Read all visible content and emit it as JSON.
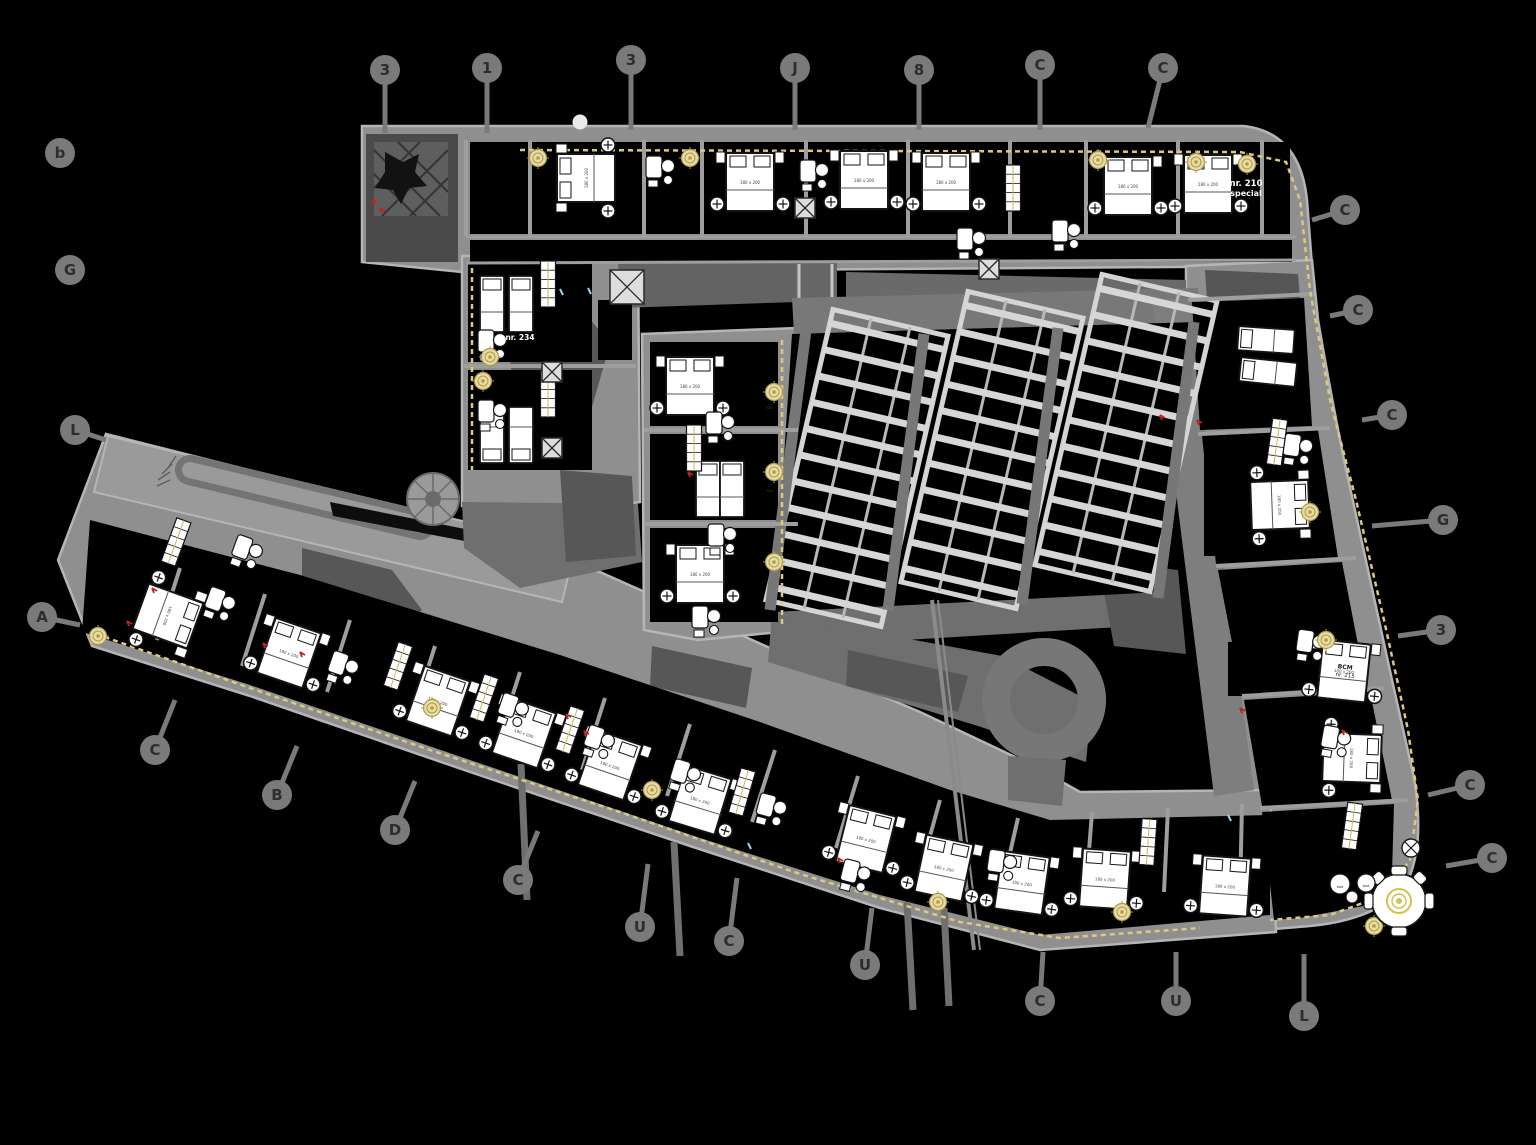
{
  "meta": {
    "title": "CAD hotel floor plan drawing"
  },
  "colors": {
    "bg": "#000000",
    "slab": "#8f8f8f",
    "slab_edge": "#b5b5b5",
    "corridor": "#6f6f6f",
    "clutter": "#575757",
    "partition": "#9e9e9e",
    "white": "#ffffff",
    "ink": "#141414",
    "beige": "#e7dca6",
    "beige_ring": "#b09a4a",
    "dash": "#d9ca7c",
    "red": "#c0221c",
    "cyan": "#93d7e6",
    "bubble": "#7a7a7a",
    "glyph": "#2d2d2d",
    "mullion": "#d4d4d4",
    "rail": "#b8b8b8",
    "walkway": "#787878"
  },
  "plan": {
    "bed_label": "180 x 200",
    "grid_bubbles": [
      {
        "x": 385,
        "y": 70,
        "g": "3",
        "ex": 385,
        "ey": 133
      },
      {
        "x": 487,
        "y": 68,
        "g": "1",
        "ex": 487,
        "ey": 133
      },
      {
        "x": 631,
        "y": 60,
        "g": "3",
        "ex": 631,
        "ey": 130
      },
      {
        "x": 795,
        "y": 68,
        "g": "J",
        "ex": 795,
        "ey": 130
      },
      {
        "x": 919,
        "y": 70,
        "g": "8",
        "ex": 919,
        "ey": 130
      },
      {
        "x": 1040,
        "y": 65,
        "g": "C",
        "ex": 1040,
        "ey": 130
      },
      {
        "x": 1163,
        "y": 68,
        "g": "C",
        "ex": 1148,
        "ey": 128
      },
      {
        "x": 60,
        "y": 153,
        "g": "b"
      },
      {
        "x": 70,
        "y": 270,
        "g": "G"
      },
      {
        "x": 75,
        "y": 430,
        "g": "L",
        "ex": 106,
        "ey": 440
      },
      {
        "x": 42,
        "y": 617,
        "g": "A",
        "ex": 80,
        "ey": 625
      },
      {
        "x": 155,
        "y": 750,
        "g": "C",
        "ex": 175,
        "ey": 700
      },
      {
        "x": 277,
        "y": 795,
        "g": "B",
        "ex": 297,
        "ey": 746
      },
      {
        "x": 395,
        "y": 830,
        "g": "D",
        "ex": 415,
        "ey": 781
      },
      {
        "x": 518,
        "y": 880,
        "g": "C",
        "ex": 538,
        "ey": 831
      },
      {
        "x": 640,
        "y": 927,
        "g": "U",
        "ex": 648,
        "ey": 864
      },
      {
        "x": 729,
        "y": 941,
        "g": "C",
        "ex": 737,
        "ey": 878
      },
      {
        "x": 865,
        "y": 965,
        "g": "U",
        "ex": 872,
        "ey": 908
      },
      {
        "x": 1040,
        "y": 1001,
        "g": "C",
        "ex": 1043,
        "ey": 952
      },
      {
        "x": 1176,
        "y": 1001,
        "g": "U",
        "ex": 1176,
        "ey": 952
      },
      {
        "x": 1304,
        "y": 1016,
        "g": "L",
        "ex": 1304,
        "ey": 954
      },
      {
        "x": 1345,
        "y": 210,
        "g": "C",
        "ex": 1312,
        "ey": 220
      },
      {
        "x": 1358,
        "y": 310,
        "g": "C",
        "ex": 1330,
        "ey": 316
      },
      {
        "x": 1392,
        "y": 415,
        "g": "C",
        "ex": 1362,
        "ey": 420
      },
      {
        "x": 1443,
        "y": 520,
        "g": "G",
        "ex": 1372,
        "ey": 526
      },
      {
        "x": 1441,
        "y": 630,
        "g": "3",
        "ex": 1398,
        "ey": 636
      },
      {
        "x": 1470,
        "y": 785,
        "g": "C",
        "ex": 1428,
        "ey": 795
      },
      {
        "x": 1492,
        "y": 858,
        "g": "C",
        "ex": 1446,
        "ey": 866
      }
    ],
    "beds": [
      [
        586,
        178,
        -90,
        "d"
      ],
      [
        750,
        182,
        0,
        "d"
      ],
      [
        864,
        180,
        0,
        "d"
      ],
      [
        946,
        182,
        0,
        "d"
      ],
      [
        1128,
        186,
        0,
        "d"
      ],
      [
        1208,
        184,
        0,
        "d"
      ],
      [
        1266,
        340,
        -86,
        "s"
      ],
      [
        1268,
        372,
        -84,
        "s"
      ],
      [
        1280,
        505,
        88,
        "d"
      ],
      [
        1344,
        671,
        6,
        "d"
      ],
      [
        1352,
        758,
        92,
        "d"
      ],
      [
        1225,
        886,
        4,
        "d"
      ],
      [
        1105,
        879,
        4,
        "d"
      ],
      [
        1022,
        883,
        8,
        "d"
      ],
      [
        168,
        616,
        110,
        "d"
      ],
      [
        289,
        653,
        19,
        "d"
      ],
      [
        438,
        701,
        19,
        "d"
      ],
      [
        524,
        733,
        19,
        "d"
      ],
      [
        610,
        765,
        19,
        "d"
      ],
      [
        700,
        800,
        17,
        "d"
      ],
      [
        866,
        839,
        14,
        "d"
      ],
      [
        944,
        868,
        12,
        "d"
      ],
      [
        492,
        304,
        0,
        "s"
      ],
      [
        521,
        304,
        0,
        "s"
      ],
      [
        492,
        435,
        180,
        "s"
      ],
      [
        521,
        435,
        180,
        "s"
      ],
      [
        690,
        386,
        0,
        "d"
      ],
      [
        708,
        489,
        0,
        "s"
      ],
      [
        732,
        489,
        0,
        "s"
      ],
      [
        700,
        574,
        0,
        "d"
      ]
    ],
    "baths": [
      [
        654,
        168,
        0
      ],
      [
        808,
        172,
        0
      ],
      [
        965,
        240,
        0
      ],
      [
        1060,
        232,
        0
      ],
      [
        1292,
        446,
        8
      ],
      [
        1305,
        642,
        8
      ],
      [
        1330,
        738,
        10
      ],
      [
        215,
        600,
        20
      ],
      [
        338,
        664,
        19
      ],
      [
        508,
        706,
        19
      ],
      [
        594,
        738,
        19
      ],
      [
        680,
        772,
        17
      ],
      [
        766,
        806,
        15
      ],
      [
        850,
        872,
        14
      ],
      [
        996,
        862,
        8
      ],
      [
        486,
        342,
        0
      ],
      [
        486,
        412,
        0
      ],
      [
        714,
        424,
        0
      ],
      [
        716,
        536,
        0
      ],
      [
        700,
        618,
        0
      ],
      [
        242,
        548,
        20
      ]
    ],
    "closets": [
      [
        548,
        284,
        0
      ],
      [
        548,
        394,
        0
      ],
      [
        1013,
        188,
        0
      ],
      [
        1277,
        442,
        8
      ],
      [
        398,
        666,
        19
      ],
      [
        484,
        698,
        19
      ],
      [
        570,
        730,
        19
      ],
      [
        742,
        792,
        16
      ],
      [
        1352,
        826,
        8
      ],
      [
        1148,
        842,
        4
      ],
      [
        176,
        542,
        20
      ],
      [
        694,
        448,
        0
      ]
    ],
    "xboxes": [
      [
        627,
        287,
        34
      ],
      [
        989,
        269,
        20
      ],
      [
        552,
        372,
        20
      ],
      [
        552,
        448,
        20
      ],
      [
        805,
        208,
        20
      ]
    ],
    "rosettes": [
      [
        538,
        158
      ],
      [
        690,
        158
      ],
      [
        1098,
        160
      ],
      [
        1196,
        162
      ],
      [
        1247,
        164
      ],
      [
        490,
        357
      ],
      [
        483,
        381
      ],
      [
        774,
        392
      ],
      [
        774,
        472
      ],
      [
        774,
        562
      ],
      [
        1310,
        512
      ],
      [
        1326,
        640
      ],
      [
        1374,
        926
      ],
      [
        1122,
        912
      ],
      [
        938,
        902
      ],
      [
        432,
        708
      ],
      [
        98,
        636
      ],
      [
        652,
        790
      ]
    ],
    "dash_lines": [
      [
        [
          520,
          150
        ],
        [
          1240,
          152
        ],
        [
          1286,
          162
        ],
        [
          1300,
          200
        ],
        [
          1310,
          290
        ],
        [
          1330,
          400
        ],
        [
          1356,
          500
        ],
        [
          1384,
          620
        ],
        [
          1408,
          730
        ],
        [
          1418,
          800
        ],
        [
          1410,
          860
        ],
        [
          1382,
          896
        ],
        [
          1330,
          915
        ],
        [
          1270,
          920
        ]
      ],
      [
        [
          96,
          634
        ],
        [
          250,
          688
        ],
        [
          430,
          750
        ],
        [
          620,
          812
        ],
        [
          800,
          874
        ],
        [
          960,
          922
        ],
        [
          1060,
          938
        ],
        [
          1200,
          928
        ]
      ],
      [
        [
          472,
          268
        ],
        [
          472,
          470
        ]
      ],
      [
        [
          782,
          340
        ],
        [
          782,
          626
        ]
      ]
    ],
    "partition_segs": [
      [
        1188,
        300,
        1314,
        294
      ],
      [
        1198,
        434,
        1330,
        428
      ],
      [
        1216,
        566,
        1356,
        558
      ],
      [
        1242,
        696,
        1384,
        688
      ],
      [
        1260,
        808,
        1408,
        800
      ],
      [
        180,
        568,
        157,
        640
      ],
      [
        265,
        594,
        242,
        666
      ],
      [
        350,
        620,
        327,
        692
      ],
      [
        435,
        646,
        412,
        718
      ],
      [
        520,
        672,
        497,
        744
      ],
      [
        605,
        698,
        582,
        770
      ],
      [
        690,
        724,
        667,
        796
      ],
      [
        775,
        750,
        752,
        822
      ],
      [
        858,
        776,
        836,
        848
      ],
      [
        940,
        800,
        920,
        872
      ],
      [
        1018,
        818,
        1002,
        888
      ],
      [
        1092,
        812,
        1086,
        890
      ],
      [
        1168,
        808,
        1164,
        892
      ],
      [
        1242,
        804,
        1240,
        894
      ],
      [
        464,
        366,
        636,
        366
      ],
      [
        644,
        430,
        798,
        430
      ],
      [
        644,
        524,
        798,
        524
      ]
    ],
    "top_wing_partition_xs": [
      466,
      530,
      644,
      702,
      806,
      908,
      1010,
      1086,
      1178,
      1262
    ],
    "skylights": {
      "w": 118,
      "h": 298,
      "a": 13,
      "rungs": 11,
      "items": [
        {
          "cx": 857,
          "cy": 468
        },
        {
          "cx": 992,
          "cy": 450
        },
        {
          "cx": 1126,
          "cy": 433
        }
      ]
    },
    "walkway_lines": [
      [
        806,
        330,
        770,
        610
      ],
      [
        924,
        334,
        888,
        610
      ],
      [
        1058,
        328,
        1022,
        604
      ],
      [
        1194,
        322,
        1158,
        598
      ]
    ],
    "joint_lines": [
      [
        932,
        600,
        974,
        950,
        4
      ],
      [
        938,
        600,
        980,
        950,
        2
      ]
    ],
    "grid_stubs": [
      [
        674,
        842,
        680,
        956
      ],
      [
        907,
        902,
        913,
        1010
      ],
      [
        521,
        764,
        527,
        900
      ],
      [
        944,
        908,
        949,
        1006
      ]
    ],
    "red_marks": [
      [
        372,
        200
      ],
      [
        380,
        208
      ],
      [
        566,
        714
      ],
      [
        584,
        731
      ],
      [
        152,
        588
      ],
      [
        127,
        621
      ],
      [
        263,
        643
      ],
      [
        300,
        652
      ],
      [
        1160,
        415
      ],
      [
        1197,
        420
      ],
      [
        838,
        858
      ],
      [
        1240,
        708
      ],
      [
        688,
        472
      ],
      [
        1342,
        730
      ]
    ],
    "cyan_marks": [
      [
        560,
        289
      ],
      [
        588,
        288
      ],
      [
        748,
        843
      ],
      [
        1228,
        815
      ]
    ],
    "labels": [
      {
        "t": "nr. 210",
        "x": 1246,
        "y": 186,
        "s": 8.5,
        "c": "#ffffff",
        "b": 1
      },
      {
        "t": "special",
        "x": 1246,
        "y": 196,
        "s": 8,
        "c": "#ffffff",
        "b": 1
      },
      {
        "t": "nr. 234",
        "x": 520,
        "y": 340,
        "s": 7.5,
        "c": "#ffffff",
        "b": 1
      },
      {
        "t": "BCM",
        "x": 1345,
        "y": 669,
        "s": 6,
        "c": "#1a1a1a",
        "b": 1,
        "r": 6
      },
      {
        "t": "nr. 215",
        "x": 1345,
        "y": 677,
        "s": 5.5,
        "c": "#1a1a1a",
        "r": 6
      },
      {
        "t": "bad",
        "x": 1340,
        "y": 888,
        "s": 3.6,
        "c": "#333333"
      },
      {
        "t": "bad",
        "x": 1366,
        "y": 887,
        "s": 3.6,
        "c": "#333333"
      },
      {
        "t": "Bad",
        "x": 770,
        "y": 409,
        "s": 3.6,
        "c": "#333333"
      },
      {
        "t": "Bad",
        "x": 770,
        "y": 492,
        "s": 3.6,
        "c": "#333333"
      }
    ]
  }
}
